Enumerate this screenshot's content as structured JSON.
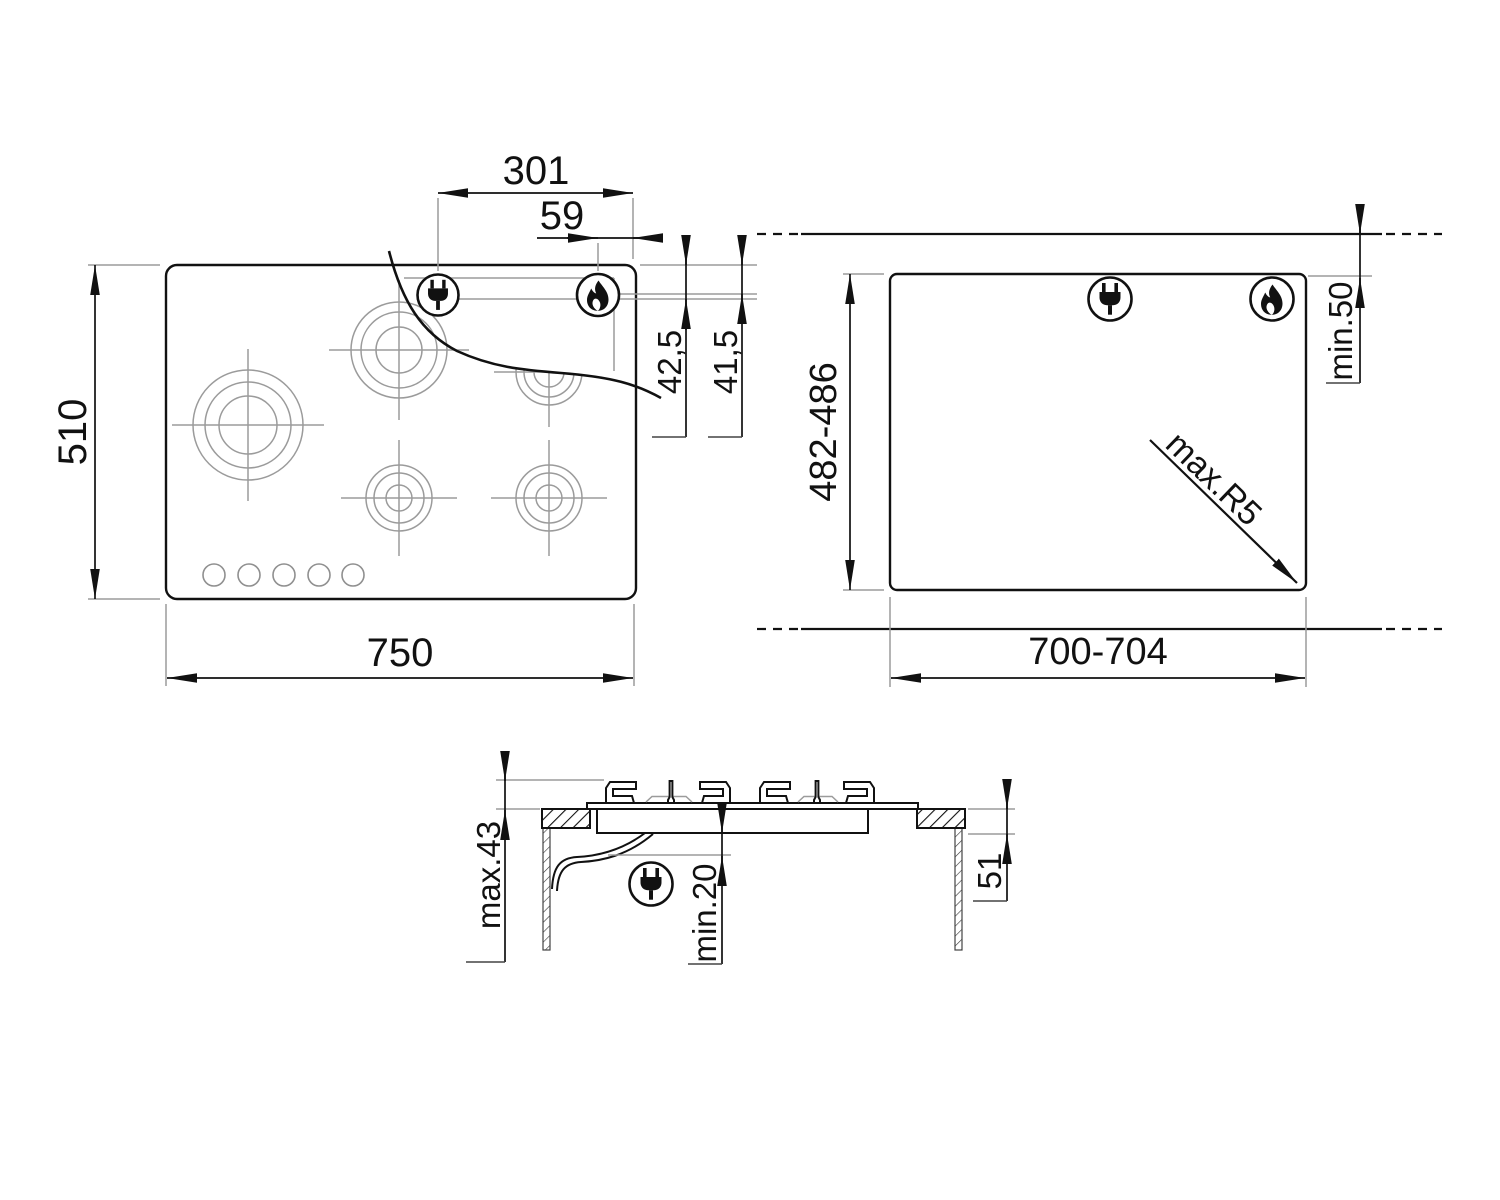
{
  "views": {
    "plan": {
      "title": "hob-top-view",
      "dims": {
        "plug_offset": "301",
        "flame_offset": "59",
        "plug_rear": "42,5",
        "flame_rear": "41,5",
        "depth": "510",
        "width": "750"
      }
    },
    "cutout": {
      "title": "worktop-cutout-view",
      "dims": {
        "depth_range": "482-486",
        "width_range": "700-704",
        "rear_clearance": "min.50",
        "corner_radius": "max.R5"
      }
    },
    "section": {
      "title": "side-section-view",
      "dims": {
        "height_above_top": "max.43",
        "clearance_below": "min.20",
        "built_in_depth": "51"
      }
    }
  },
  "icons": {
    "plug": "power-plug-icon",
    "flame": "gas-flame-icon"
  },
  "colors": {
    "line": "#111111",
    "thin_line": "#9b9b9b",
    "background": "#ffffff"
  }
}
